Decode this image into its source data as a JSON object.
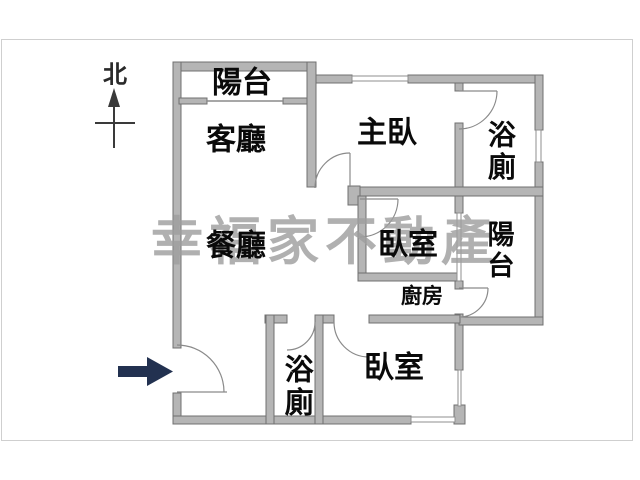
{
  "compass": {
    "label": "北"
  },
  "watermark": {
    "text": "幸福家不動產",
    "color": "#9f9f9f"
  },
  "entry_arrow": {
    "direction": "right",
    "color": "#223150"
  },
  "palette": {
    "wall_fill": "#b5b5b5",
    "wall_stroke": "#707070",
    "door_arc": "#8a8a8a",
    "label_color": "#0a0a0a",
    "background": "#ffffff"
  },
  "rooms": {
    "balcony_top": "陽台",
    "living_room": "客廳",
    "master_bedroom": "主臥",
    "bathroom_top": "浴廁",
    "dining_room": "餐廳",
    "bedroom_middle": "臥室",
    "balcony_right": "陽台",
    "kitchen": "廚房",
    "bathroom_bottom": "浴廁",
    "bedroom_bottom": "臥室"
  }
}
